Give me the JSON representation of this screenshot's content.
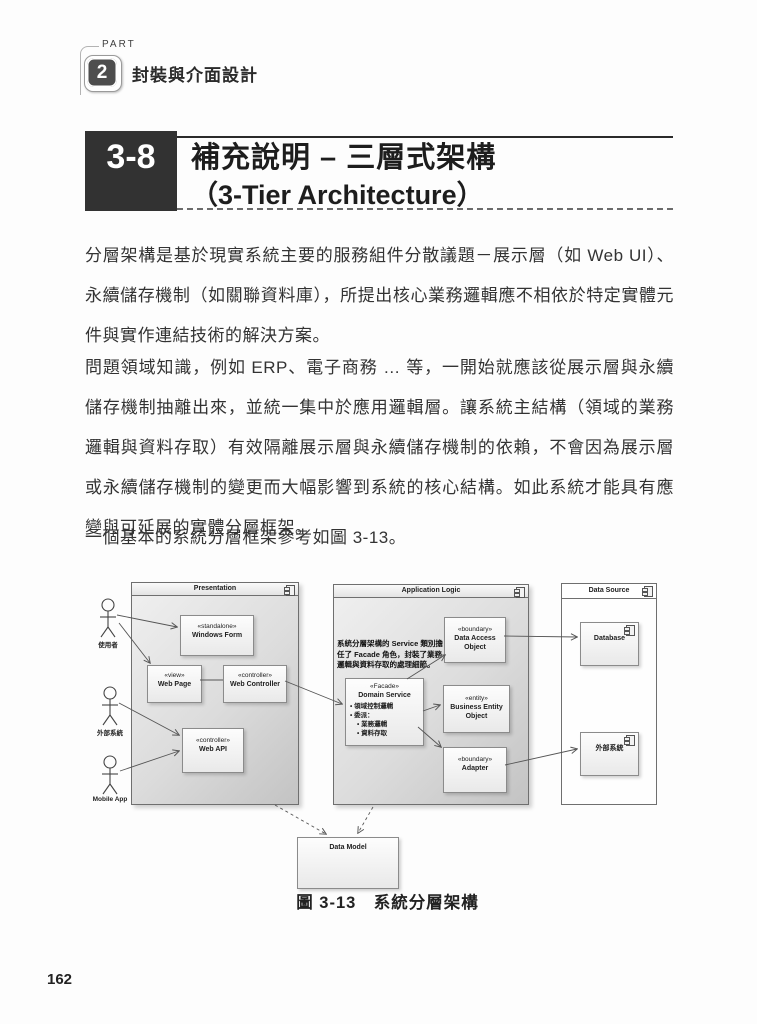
{
  "page": {
    "part_label": "PART",
    "part_number": "2",
    "part_title": "封裝與介面設計",
    "section_number": "3-8",
    "section_title_line1": "補充說明 – 三層式架構",
    "section_title_line2": "（3-Tier Architecture）",
    "paragraph1": "分層架構是基於現實系統主要的服務組件分散議題－展示層（如 Web UI）、永續儲存機制（如關聯資料庫），所提出核心業務邏輯應不相依於特定實體元件與實作連結技術的解決方案。",
    "paragraph2": "問題領域知識，例如 ERP、電子商務 … 等，一開始就應該從展示層與永續儲存機制抽離出來，並統一集中於應用邏輯層。讓系統主結構（領域的業務邏輯與資料存取）有效隔離展示層與永續儲存機制的依賴，不會因為展示層或永續儲存機制的變更而大幅影響到系統的核心結構。如此系統才能具有應變與可延展的實體分層框架。",
    "paragraph3": "一個基本的系統分層框架參考如圖 3-13。",
    "figure_caption": "圖 3-13　系統分層架構",
    "page_number": "162"
  },
  "diagram": {
    "packages": {
      "presentation": "Presentation",
      "application_logic": "Application Logic",
      "data_source": "Data Source"
    },
    "actors": [
      {
        "label": "使用者"
      },
      {
        "label": "外部系統"
      },
      {
        "label": "Mobile App"
      }
    ],
    "note": "系統分層架構的 Service 類別擔任了 Facade 角色，封裝了業務邏輯與資料存取的處理細節。",
    "nodes": {
      "windows_form": {
        "stereotype": "«standalone»",
        "name": "Windows Form"
      },
      "web_page": {
        "stereotype": "«view»",
        "name": "Web Page"
      },
      "web_controller": {
        "stereotype": "«controller»",
        "name": "Web Controller"
      },
      "web_api": {
        "stereotype": "«controller»",
        "name": "Web API"
      },
      "data_access_object": {
        "stereotype": "«boundary»",
        "name": "Data Access Object"
      },
      "domain_service": {
        "stereotype": "«Facade»",
        "name": "Domain Service",
        "bullets": [
          "• 領域控制邏輯",
          "• 委派：",
          "• 業務邏輯",
          "• 資料存取"
        ]
      },
      "business_entity_object": {
        "stereotype": "«entity»",
        "name": "Business Entity Object"
      },
      "adapter": {
        "stereotype": "«boundary»",
        "name": "Adapter"
      },
      "database": {
        "name": "Database"
      },
      "external_system": {
        "name": "外部系統"
      },
      "data_model": {
        "name": "Data Model"
      }
    }
  }
}
